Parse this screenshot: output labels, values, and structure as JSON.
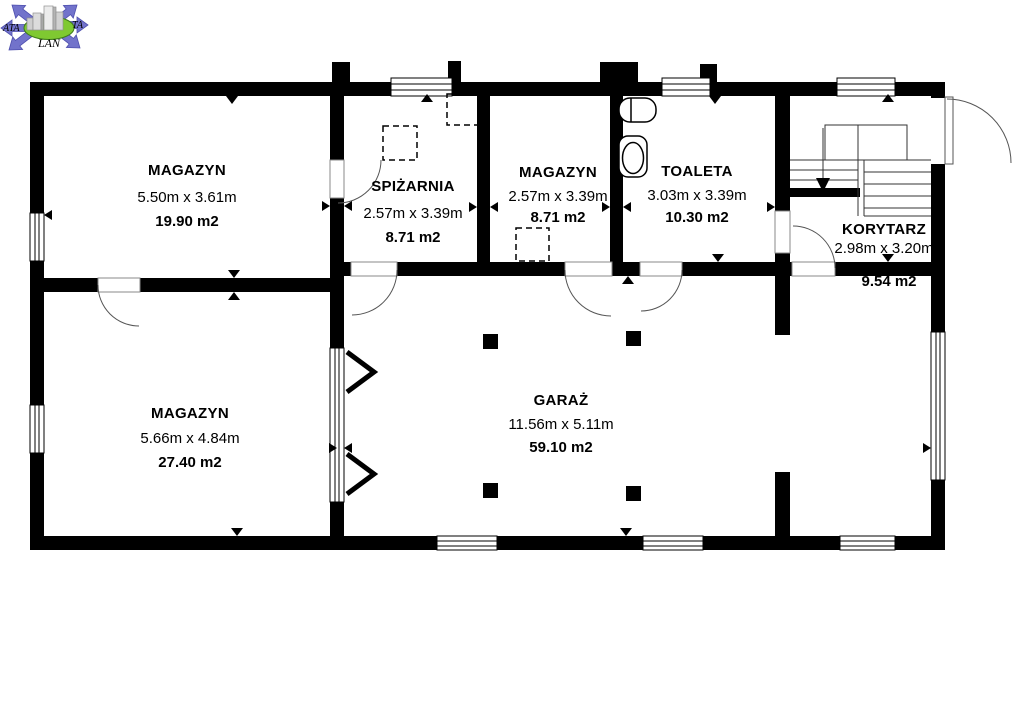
{
  "logo": {
    "text_left": "ATA",
    "text_right": "TA",
    "text_bottom": "LAN"
  },
  "rooms": [
    {
      "name": "MAGAZYN",
      "dimensions": "5.50m x 3.61m",
      "area": "19.90 m2"
    },
    {
      "name": "SPIŻARNIA",
      "dimensions": "2.57m x 3.39m",
      "area": "8.71 m2"
    },
    {
      "name": "MAGAZYN",
      "dimensions": "2.57m x 3.39m",
      "area": "8.71 m2"
    },
    {
      "name": "TOALETA",
      "dimensions": "3.03m x 3.39m",
      "area": "10.30 m2"
    },
    {
      "name": "KORYTARZ",
      "dimensions": "2.98m x 3.20m",
      "area": "9.54 m2"
    },
    {
      "name": "MAGAZYN",
      "dimensions": "5.66m x 4.84m",
      "area": "27.40 m2"
    },
    {
      "name": "GARAŻ",
      "dimensions": "11.56m x 5.11m",
      "area": "59.10 m2"
    }
  ],
  "colors": {
    "walls": "#000000",
    "background": "#ffffff",
    "thin_lines": "#444444",
    "logo_arrows": "#7273cb",
    "logo_ellipse": "#7fc931"
  }
}
